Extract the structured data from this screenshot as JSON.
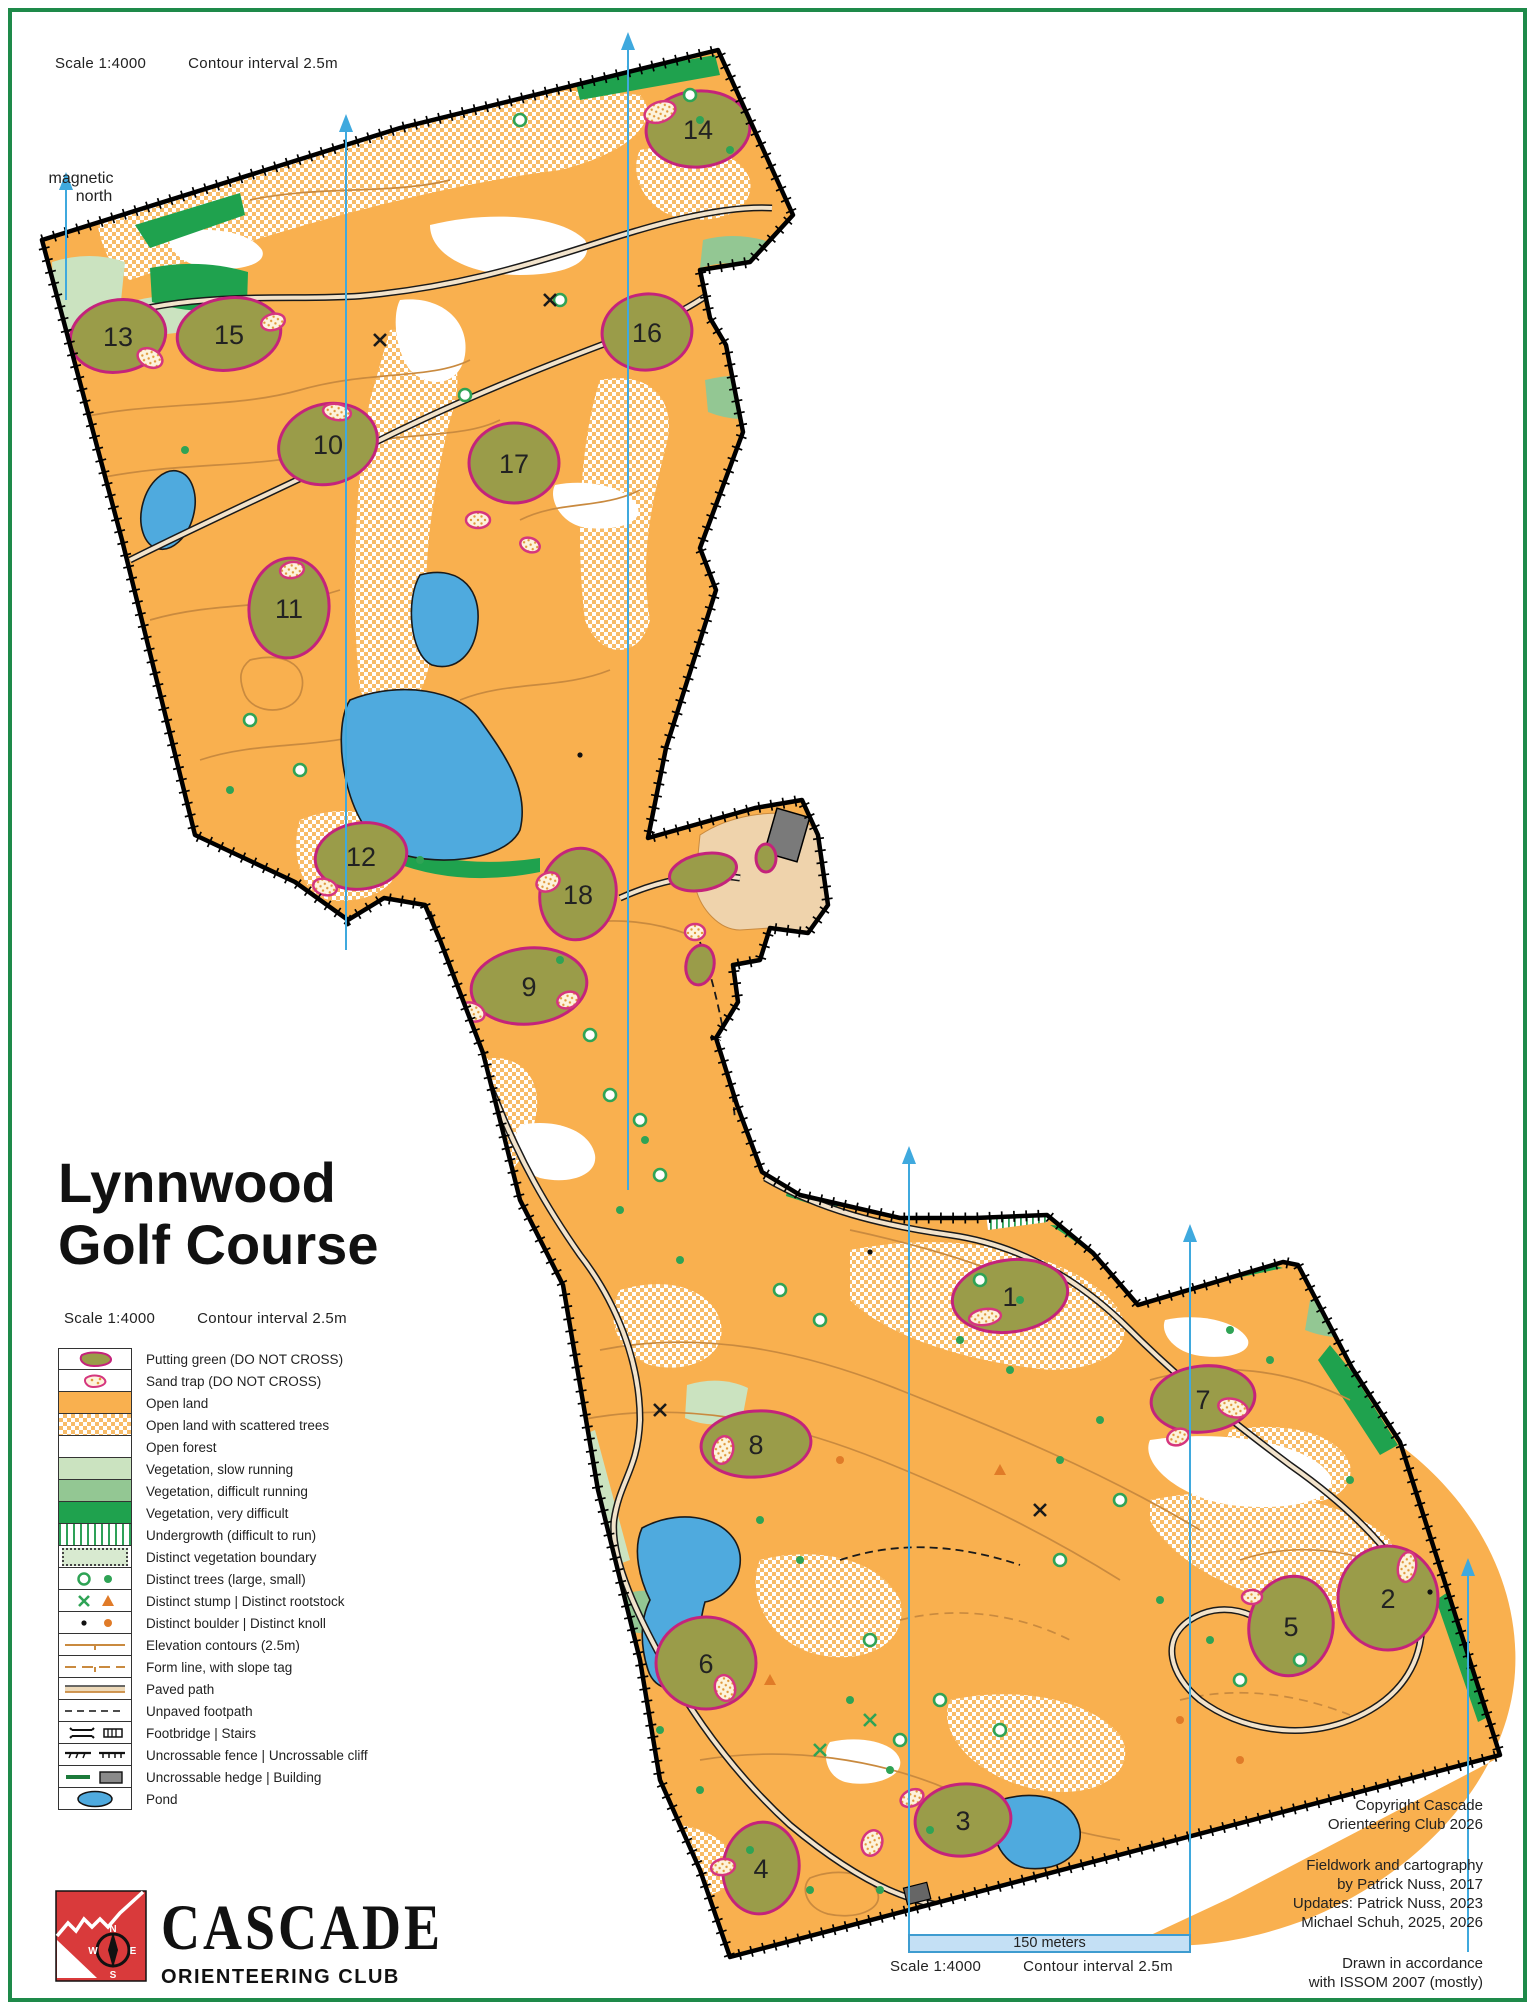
{
  "scale_top": {
    "scale": "Scale  1:4000",
    "contour": "Contour interval  2.5m"
  },
  "magnetic_north": {
    "line1": "magnetic",
    "line2": "north"
  },
  "title": {
    "line1": "Lynnwood",
    "line2": "Golf Course"
  },
  "scale_title": {
    "scale": "Scale  1:4000",
    "contour": "Contour interval  2.5m"
  },
  "legend": {
    "items": [
      {
        "label": "Putting green (DO NOT CROSS)"
      },
      {
        "label": "Sand trap (DO NOT CROSS)"
      },
      {
        "label": "Open land"
      },
      {
        "label": "Open land with scattered trees"
      },
      {
        "label": "Open forest"
      },
      {
        "label": "Vegetation, slow running"
      },
      {
        "label": "Vegetation, difficult running"
      },
      {
        "label": "Vegetation, very difficult"
      },
      {
        "label": "Undergrowth (difficult to run)"
      },
      {
        "label": "Distinct vegetation boundary"
      },
      {
        "label": "Distinct trees (large, small)"
      },
      {
        "label": "Distinct stump | Distinct rootstock"
      },
      {
        "label": "Distinct boulder | Distinct knoll"
      },
      {
        "label": "Elevation contours (2.5m)"
      },
      {
        "label": "Form line, with slope tag"
      },
      {
        "label": "Paved path"
      },
      {
        "label": "Unpaved footpath"
      },
      {
        "label": "Footbridge | Stairs"
      },
      {
        "label": "Uncrossable fence | Uncrossable cliff"
      },
      {
        "label": "Uncrossable hedge | Building"
      },
      {
        "label": "Pond"
      }
    ]
  },
  "holes": [
    "1",
    "2",
    "3",
    "4",
    "5",
    "6",
    "7",
    "8",
    "9",
    "10",
    "11",
    "12",
    "13",
    "14",
    "15",
    "16",
    "17",
    "18"
  ],
  "logo": {
    "name": "CASCADE",
    "sub": "ORIENTEERING CLUB",
    "compass": {
      "n": "N",
      "s": "S",
      "e": "E",
      "w": "W"
    }
  },
  "credits": {
    "copyright1": "Copyright Cascade",
    "copyright2": "Orienteering Club 2026",
    "fieldwork1": "Fieldwork and cartography",
    "fieldwork2": "by Patrick Nuss, 2017",
    "fieldwork3": "Updates: Patrick Nuss, 2023",
    "fieldwork4": "Michael Schuh, 2025, 2026",
    "issom1": "Drawn in accordance",
    "issom2": "with ISSOM 2007 (mostly)"
  },
  "scalebar": {
    "label": "150 meters",
    "scale": "Scale  1:4000",
    "contour": "Contour interval  2.5m"
  },
  "colors": {
    "open_land": "#F9B04F",
    "putting_green": "#9A9C49",
    "green_border": "#C4237B",
    "veg_slow": "#CBE3C0",
    "veg_difficult": "#93C793",
    "veg_very_difficult": "#1FA24E",
    "pond": "#4FAADE",
    "contour": "#C98A3F",
    "north_line": "#3FA9DE",
    "page_border": "#1E8A4A",
    "paved": "#EFD3AC",
    "building": "#7A7A7A"
  }
}
